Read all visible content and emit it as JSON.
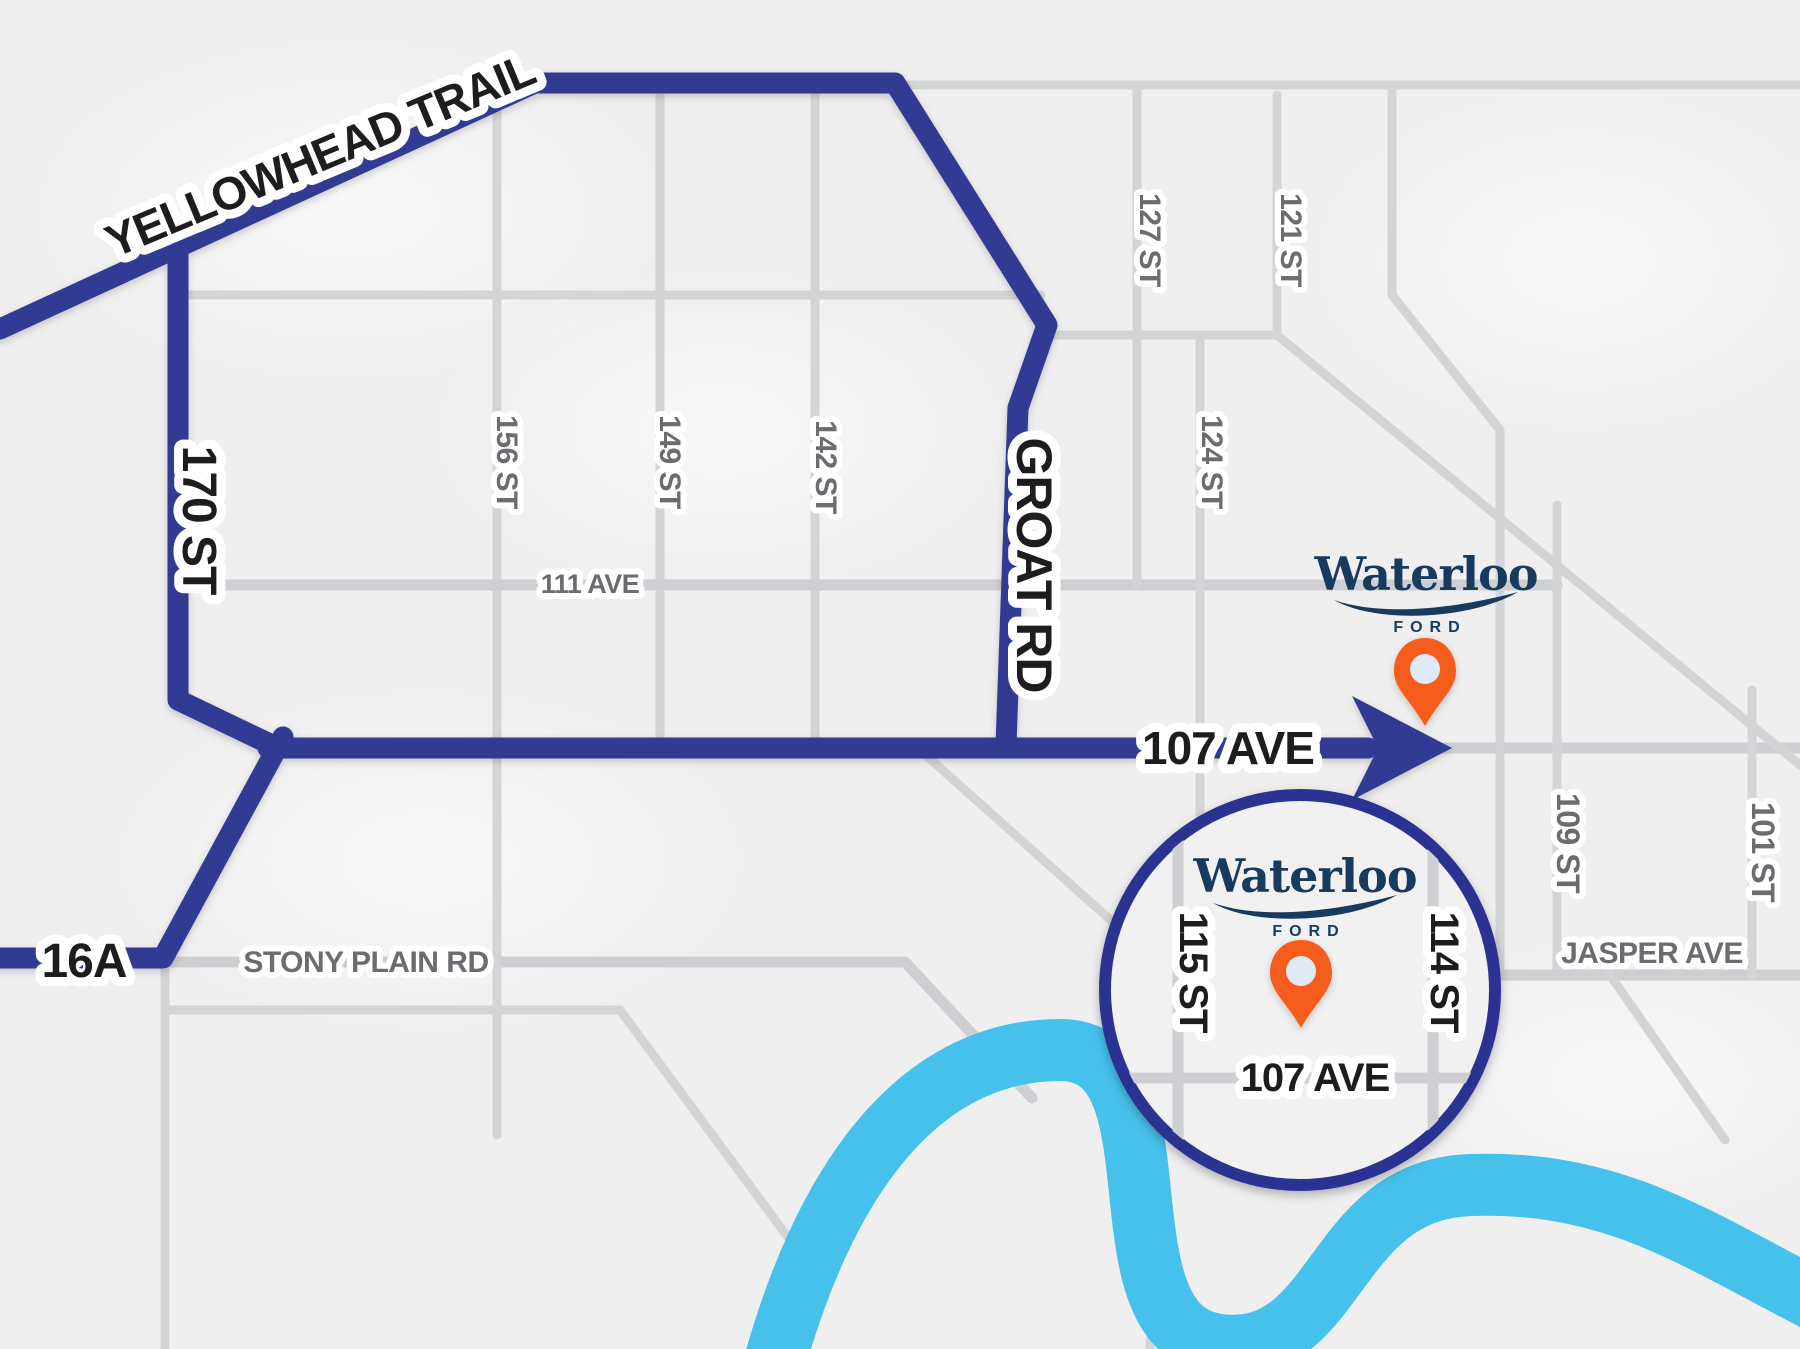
{
  "map_description": "Stylized dealership directions map (Edmonton) with highlighted driving routes, magnifier inset and location pins",
  "brand": {
    "name": "Waterloo",
    "division": "FORD"
  },
  "routes": {
    "yellowhead_trail": "YELLOWHEAD TRAIL",
    "st_170": "170 ST",
    "groat_rd": "GROAT RD",
    "ave_107": "107 AVE",
    "hwy_16a": "16A"
  },
  "streets": {
    "st_156": "156 ST",
    "st_149": "149 ST",
    "st_142": "142 ST",
    "st_127": "127 ST",
    "st_121": "121 ST",
    "st_124": "124 ST",
    "ave_111": "111 AVE",
    "stony_plain_rd": "STONY PLAIN RD",
    "st_109": "109 ST",
    "st_101": "101 ST",
    "jasper_ave": "JASPER AVE"
  },
  "inset": {
    "st_115": "115 ST",
    "st_114": "114 ST",
    "ave_107": "107 AVE"
  },
  "colors": {
    "land": "#efeff0",
    "road": "#d2d4d6",
    "route_highlight": "#323b94",
    "inset_ring": "#2c3192",
    "river": "#45c1ec",
    "pin": "#f65c1f",
    "pin_center": "#dfeaf6",
    "logo_navy": "#173a5f",
    "street_label": "#6a6c70",
    "route_label": "#1d1d1f"
  }
}
